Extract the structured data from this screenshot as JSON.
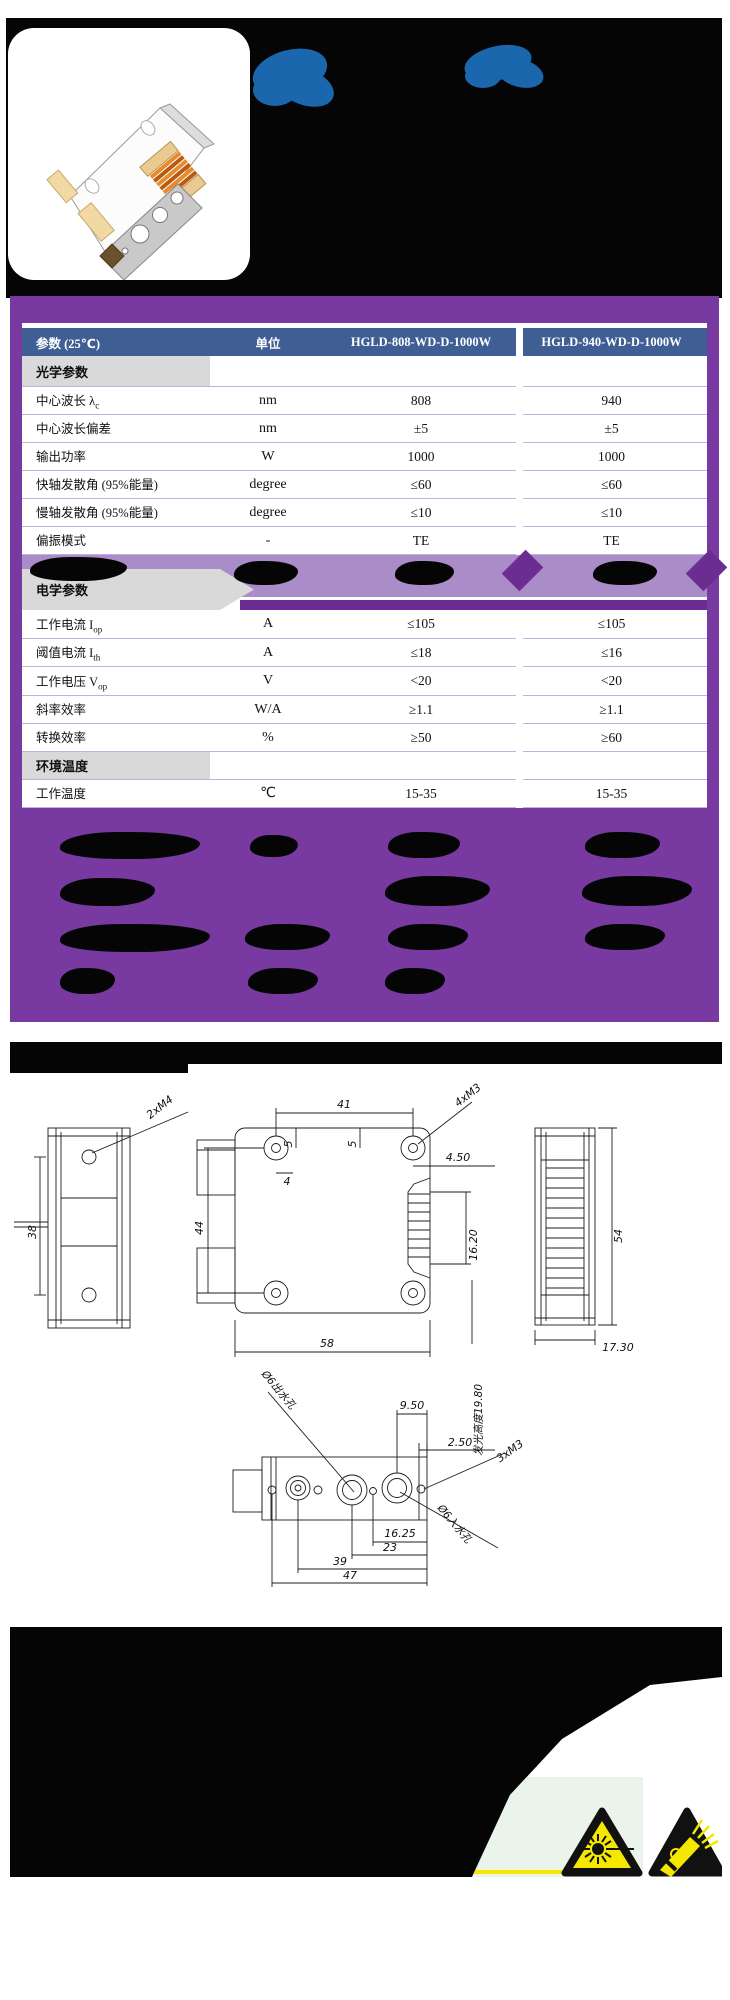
{
  "colors": {
    "purple": "#7839A0",
    "purple_dark": "#6B2D92",
    "lavender": "#AA8CC8",
    "separator": "#C9ADE0",
    "section_gray": "#D9D9D9",
    "header_blue": "#3E5E94",
    "blob_blue": "#1A67AE",
    "warning_yellow": "#F4E800",
    "pale_green": "#EAF4EA"
  },
  "images": {
    "product_photo": "laser-diode-stack-illustration"
  },
  "icons": {
    "laser": "laser-warning-triangle",
    "esd": "esd-warning-triangle"
  },
  "table": {
    "columns": {
      "param": "参数 (25℃)",
      "unit": "单位",
      "model_a": "HGLD-808-WD-D-1000W",
      "model_b": "HGLD-940-WD-D-1000W"
    },
    "rows": [
      {
        "type": "section",
        "label": "光学参数"
      },
      {
        "type": "data",
        "label": "中心波长 λ",
        "sub": "c",
        "unit": "nm",
        "a": "808",
        "b": "940"
      },
      {
        "type": "data",
        "label": "中心波长偏差",
        "sub": "",
        "unit": "nm",
        "a": "±5",
        "b": "±5"
      },
      {
        "type": "data",
        "label": "输出功率",
        "sub": "",
        "unit": "W",
        "a": "1000",
        "b": "1000"
      },
      {
        "type": "data",
        "label": "快轴发散角 (95%能量)",
        "sub": "",
        "unit": "degree",
        "a": "≤60",
        "b": "≤60"
      },
      {
        "type": "data",
        "label": "慢轴发散角 (95%能量)",
        "sub": "",
        "unit": "degree",
        "a": "≤10",
        "b": "≤10"
      },
      {
        "type": "data",
        "label": "偏振模式",
        "sub": "",
        "unit": "-",
        "a": "TE",
        "b": "TE"
      },
      {
        "type": "deco",
        "label": "电学参数"
      },
      {
        "type": "data",
        "label": "工作电流 I",
        "sub": "op",
        "unit": "A",
        "a": "≤105",
        "b": "≤105"
      },
      {
        "type": "data",
        "label": "阈值电流 I",
        "sub": "th",
        "unit": "A",
        "a": "≤18",
        "b": "≤16"
      },
      {
        "type": "data",
        "label": "工作电压 V",
        "sub": "op",
        "unit": "V",
        "a": "<20",
        "b": "<20"
      },
      {
        "type": "data",
        "label": "斜率效率",
        "sub": "",
        "unit": "W/A",
        "a": "≥1.1",
        "b": "≥1.1"
      },
      {
        "type": "data",
        "label": "转换效率",
        "sub": "",
        "unit": "%",
        "a": "≥50",
        "b": "≥60"
      },
      {
        "type": "section",
        "label": "环境温度"
      },
      {
        "type": "data",
        "label": "工作温度",
        "sub": "",
        "unit": "℃",
        "a": "15-35",
        "b": "15-35"
      }
    ]
  },
  "drawings": {
    "left_view": {
      "thread_label": "2xM4",
      "dim_height": "38"
    },
    "front_view": {
      "dim_41": "41",
      "thread_label": "4xM3",
      "dim_5a": "5",
      "dim_5b": "5",
      "dim_4": "4",
      "dim_44": "44",
      "dim_58": "58",
      "dim_450": "4.50",
      "dim_1620": "16.20",
      "emission_label": "发光高度19.80"
    },
    "right_view": {
      "dim_54": "54",
      "dim_1730": "17.30"
    },
    "bottom_view": {
      "outlet_label": "Ø6出水孔",
      "dim_950": "9.50",
      "dim_250": "2.50",
      "thread_label": "3xM3",
      "dim_1625": "16.25",
      "dim_23": "23",
      "dim_39": "39",
      "dim_47": "47",
      "inlet_label": "Ø6入水孔"
    }
  }
}
